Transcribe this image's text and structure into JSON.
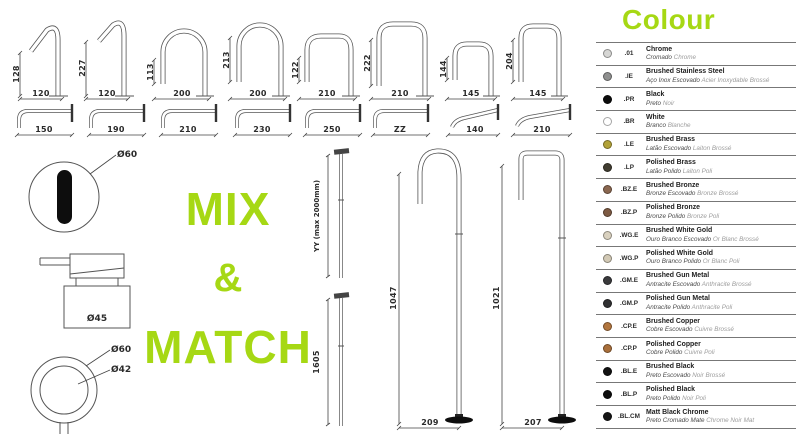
{
  "page": {
    "accent": "#a6d814",
    "mix_line1": "MIX",
    "mix_line2": "&",
    "mix_line3": "MATCH"
  },
  "row1_faucets": [
    {
      "h": "128",
      "w": "120"
    },
    {
      "h": "227",
      "w": "120"
    },
    {
      "h": "113",
      "w": "200"
    },
    {
      "h": "213",
      "w": "200"
    },
    {
      "h": "122",
      "w": "210"
    },
    {
      "h": "222",
      "w": "210"
    },
    {
      "h": "144",
      "w": "145"
    },
    {
      "h": "204",
      "w": "145"
    }
  ],
  "row2_spouts": [
    {
      "w": "150"
    },
    {
      "w": "190"
    },
    {
      "w": "210"
    },
    {
      "w": "230"
    },
    {
      "w": "250"
    },
    {
      "w": "ZZ"
    },
    {
      "w": "140"
    },
    {
      "w": "210"
    }
  ],
  "accessories": {
    "sensor_diameter": "Ø60",
    "dispenser_diameter": "Ø45",
    "knob_outer": "Ø60",
    "knob_inner": "Ø42"
  },
  "risers": [
    {
      "label": "YY (max 2000mm)"
    },
    {
      "label": "1605"
    }
  ],
  "floor_spouts": [
    {
      "h": "1047",
      "w": "209"
    },
    {
      "h": "1021",
      "w": "207"
    }
  ],
  "legend": {
    "title": "Colour",
    "entries": [
      {
        "code": ".01",
        "name": "Chrome",
        "pt": "Cromado",
        "fr": "Chrome",
        "hex": "#d6d6d4"
      },
      {
        "code": ".IE",
        "name": "Brushed Stainless Steel",
        "pt": "Aço Inox Escovado",
        "fr": "Acier Inoxydable Brossé",
        "hex": "#8f908f"
      },
      {
        "code": ".PR",
        "name": "Black",
        "pt": "Preto",
        "fr": "Noir",
        "hex": "#0c0c0c"
      },
      {
        "code": ".BR",
        "name": "White",
        "pt": "Branco",
        "fr": "Blanche",
        "hex": "#ffffff"
      },
      {
        "code": ".LE",
        "name": "Brushed Brass",
        "pt": "Latão Escovado",
        "fr": "Laiton Brossé",
        "hex": "#b2a238"
      },
      {
        "code": ".LP",
        "name": "Polished Brass",
        "pt": "Latão Polido",
        "fr": "Laiton Poli",
        "hex": "#413d31"
      },
      {
        "code": ".BZ.E",
        "name": "Brushed Bronze",
        "pt": "Bronze Escovado",
        "fr": "Bronze Brossé",
        "hex": "#8a6750"
      },
      {
        "code": ".BZ.P",
        "name": "Polished Bronze",
        "pt": "Bronze Polido",
        "fr": "Bronze Poli",
        "hex": "#7d5a43"
      },
      {
        "code": ".WG.E",
        "name": "Brushed White Gold",
        "pt": "Ouro Branco Escovado",
        "fr": "Or Blanc Brossé",
        "hex": "#d9d1bf"
      },
      {
        "code": ".WG.P",
        "name": "Polished White Gold",
        "pt": "Ouro Branco Polido",
        "fr": "Or Blanc Poli",
        "hex": "#d2c9b5"
      },
      {
        "code": ".GM.E",
        "name": "Brushed Gun Metal",
        "pt": "Antracite Escovado",
        "fr": "Anthracite Brossé",
        "hex": "#3a3a3c"
      },
      {
        "code": ".GM.P",
        "name": "Polished Gun Metal",
        "pt": "Antracite Polido",
        "fr": "Anthracite Poli",
        "hex": "#303032"
      },
      {
        "code": ".CP.E",
        "name": "Brushed Copper",
        "pt": "Cobre Escovado",
        "fr": "Cuivre Brossé",
        "hex": "#b2763e"
      },
      {
        "code": ".CP.P",
        "name": "Polished Copper",
        "pt": "Cobre Polido",
        "fr": "Cuivre Poli",
        "hex": "#a96f3b"
      },
      {
        "code": ".BL.E",
        "name": "Brushed Black",
        "pt": "Preto Escovado",
        "fr": "Noir Brossé",
        "hex": "#121212"
      },
      {
        "code": ".BL.P",
        "name": "Polished Black",
        "pt": "Preto Polido",
        "fr": "Noir Poli",
        "hex": "#0d0d0d"
      },
      {
        "code": ".BL.CM",
        "name": "Matt Black Chrome",
        "pt": "Preto Cromado Mate",
        "fr": "Chrome Noir Mat",
        "hex": "#151515"
      }
    ]
  }
}
